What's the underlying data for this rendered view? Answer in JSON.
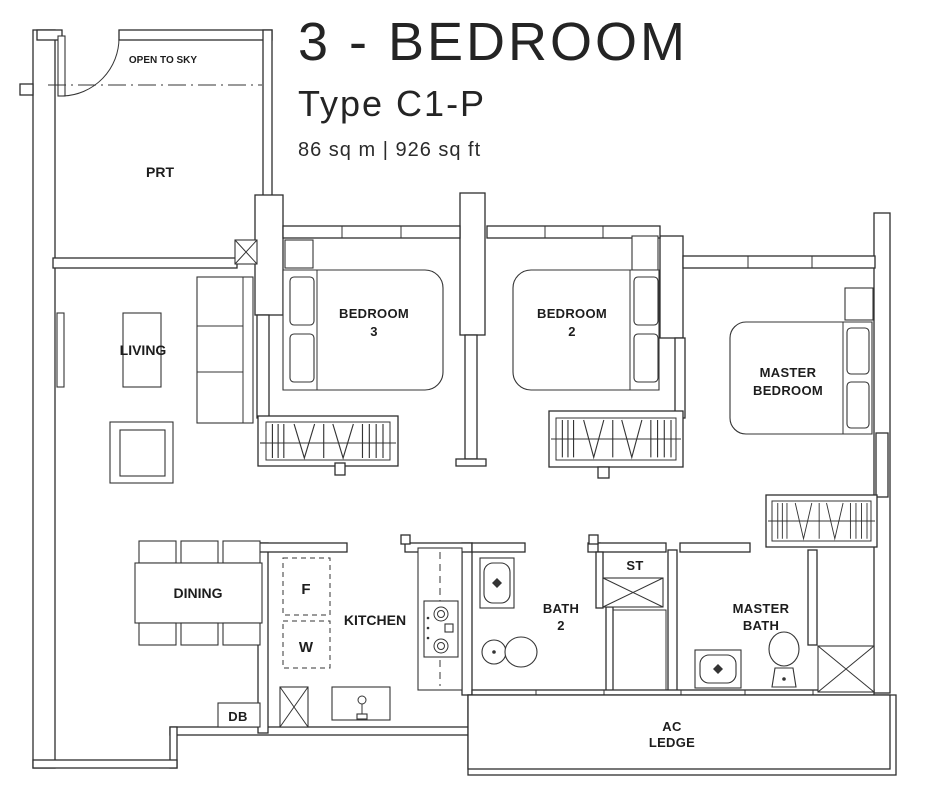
{
  "header": {
    "title": "3 - BEDROOM",
    "subtitle": "Type C1-P",
    "area": "86 sq m | 926 sq ft"
  },
  "labels": {
    "open_to_sky": "OPEN TO SKY",
    "prt": "PRT",
    "living": "LIVING",
    "dining": "DINING",
    "kitchen": "KITCHEN",
    "fridge": "F",
    "washer": "W",
    "db": "DB",
    "st": "ST",
    "bath2": [
      "BATH",
      "2"
    ],
    "bedroom3": [
      "BEDROOM",
      "3"
    ],
    "bedroom2": [
      "BEDROOM",
      "2"
    ],
    "master_bedroom": [
      "MASTER",
      "BEDROOM"
    ],
    "master_bath": [
      "MASTER",
      "BATH"
    ],
    "ac_ledge": [
      "AC",
      "LEDGE"
    ]
  },
  "colors": {
    "line": "#2e2e2e",
    "background": "#ffffff"
  }
}
